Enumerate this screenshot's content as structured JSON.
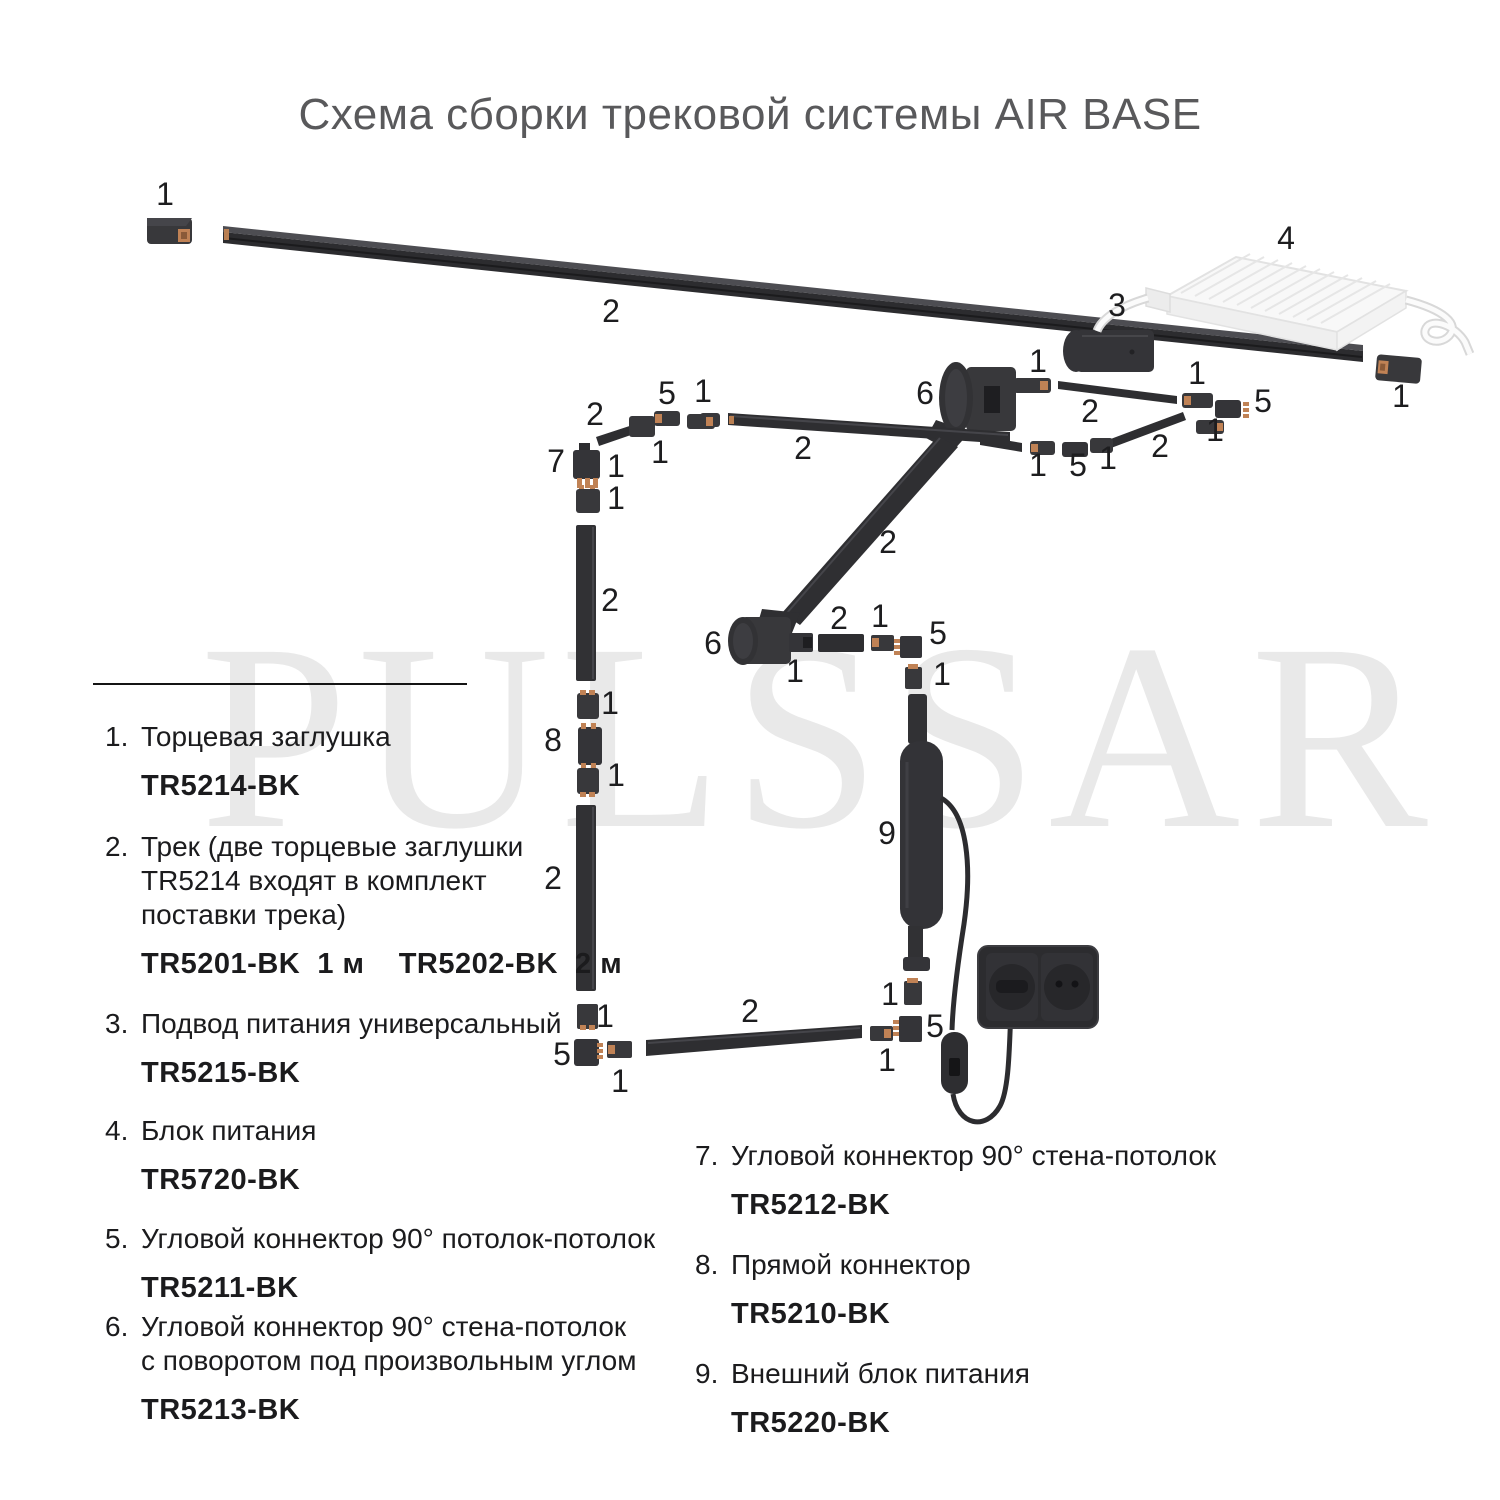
{
  "title": "Схема сборки трековой системы AIR BASE",
  "watermark": "PULSSAR",
  "colors": {
    "title_text": "#59595b",
    "body_text": "#1b1b1d",
    "watermark": "#e9e9e9",
    "track_dark": "#2e2e31",
    "part_dark": "#38383b",
    "copper_contact": "#c08255",
    "psu_white": "#f6f6f6"
  },
  "diagram": {
    "labels": [
      {
        "t": "1",
        "x": 165,
        "y": 205
      },
      {
        "t": "2",
        "x": 611,
        "y": 322
      },
      {
        "t": "3",
        "x": 1117,
        "y": 316
      },
      {
        "t": "4",
        "x": 1286,
        "y": 249
      },
      {
        "t": "1",
        "x": 1401,
        "y": 407
      },
      {
        "t": "1",
        "x": 1038,
        "y": 372
      },
      {
        "t": "2",
        "x": 1090,
        "y": 422
      },
      {
        "t": "1",
        "x": 1197,
        "y": 384
      },
      {
        "t": "5",
        "x": 1263,
        "y": 412
      },
      {
        "t": "1",
        "x": 1215,
        "y": 441
      },
      {
        "t": "2",
        "x": 1160,
        "y": 457
      },
      {
        "t": "1",
        "x": 1038,
        "y": 476
      },
      {
        "t": "5",
        "x": 1078,
        "y": 476
      },
      {
        "t": "1",
        "x": 1108,
        "y": 469
      },
      {
        "t": "6",
        "x": 925,
        "y": 404
      },
      {
        "t": "2",
        "x": 803,
        "y": 459
      },
      {
        "t": "1",
        "x": 703,
        "y": 402
      },
      {
        "t": "5",
        "x": 667,
        "y": 404
      },
      {
        "t": "2",
        "x": 595,
        "y": 425
      },
      {
        "t": "1",
        "x": 660,
        "y": 463
      },
      {
        "t": "7",
        "x": 556,
        "y": 472
      },
      {
        "t": "1",
        "x": 616,
        "y": 477
      },
      {
        "t": "1",
        "x": 616,
        "y": 509
      },
      {
        "t": "2",
        "x": 610,
        "y": 611
      },
      {
        "t": "2",
        "x": 888,
        "y": 553
      },
      {
        "t": "1",
        "x": 610,
        "y": 714
      },
      {
        "t": "8",
        "x": 553,
        "y": 751
      },
      {
        "t": "1",
        "x": 616,
        "y": 786
      },
      {
        "t": "2",
        "x": 553,
        "y": 889
      },
      {
        "t": "6",
        "x": 713,
        "y": 654
      },
      {
        "t": "1",
        "x": 795,
        "y": 682
      },
      {
        "t": "2",
        "x": 839,
        "y": 629
      },
      {
        "t": "1",
        "x": 880,
        "y": 627
      },
      {
        "t": "5",
        "x": 938,
        "y": 644
      },
      {
        "t": "1",
        "x": 942,
        "y": 685
      },
      {
        "t": "9",
        "x": 887,
        "y": 844
      },
      {
        "t": "1",
        "x": 890,
        "y": 1005
      },
      {
        "t": "5",
        "x": 935,
        "y": 1037
      },
      {
        "t": "1",
        "x": 887,
        "y": 1071
      },
      {
        "t": "1",
        "x": 605,
        "y": 1027
      },
      {
        "t": "5",
        "x": 562,
        "y": 1065
      },
      {
        "t": "1",
        "x": 620,
        "y": 1092
      },
      {
        "t": "2",
        "x": 750,
        "y": 1022
      }
    ]
  },
  "legend": {
    "items": [
      {
        "id": "1",
        "num": "1.",
        "lines": [
          "Торцевая заглушка"
        ],
        "code": "TR5214-BK",
        "top": 720,
        "left": 105
      },
      {
        "id": "2",
        "num": "2.",
        "lines": [
          "Трек (две торцевые заглушки",
          "TR5214 входят в комплект",
          "поставки трека)"
        ],
        "code": "TR5201-BK  1 м    TR5202-BK  2 м",
        "top": 830,
        "left": 105
      },
      {
        "id": "3",
        "num": "3.",
        "lines": [
          "Подвод питания универсальный"
        ],
        "code": "TR5215-BK",
        "top": 1007,
        "left": 105
      },
      {
        "id": "4",
        "num": "4.",
        "lines": [
          "Блок питания"
        ],
        "code": "TR5720-BK",
        "top": 1114,
        "left": 105
      },
      {
        "id": "5",
        "num": "5.",
        "lines": [
          "Угловой коннектор 90° потолок-потолок"
        ],
        "code": "TR5211-BK",
        "top": 1222,
        "left": 105
      },
      {
        "id": "6",
        "num": "6.",
        "lines": [
          "Угловой коннектор 90° стена-потолок",
          "с поворотом под произвольным углом"
        ],
        "code": "TR5213-BK",
        "top": 1310,
        "left": 105
      },
      {
        "id": "7",
        "num": "7.",
        "lines": [
          "Угловой коннектор 90° стена-потолок"
        ],
        "code": "TR5212-BK",
        "top": 1139,
        "left": 695
      },
      {
        "id": "8",
        "num": "8.",
        "lines": [
          "Прямой коннектор"
        ],
        "code": "TR5210-BK",
        "top": 1248,
        "left": 695
      },
      {
        "id": "9",
        "num": "9.",
        "lines": [
          "Внешний блок питания"
        ],
        "code": "TR5220-BK",
        "top": 1357,
        "left": 695
      }
    ]
  }
}
